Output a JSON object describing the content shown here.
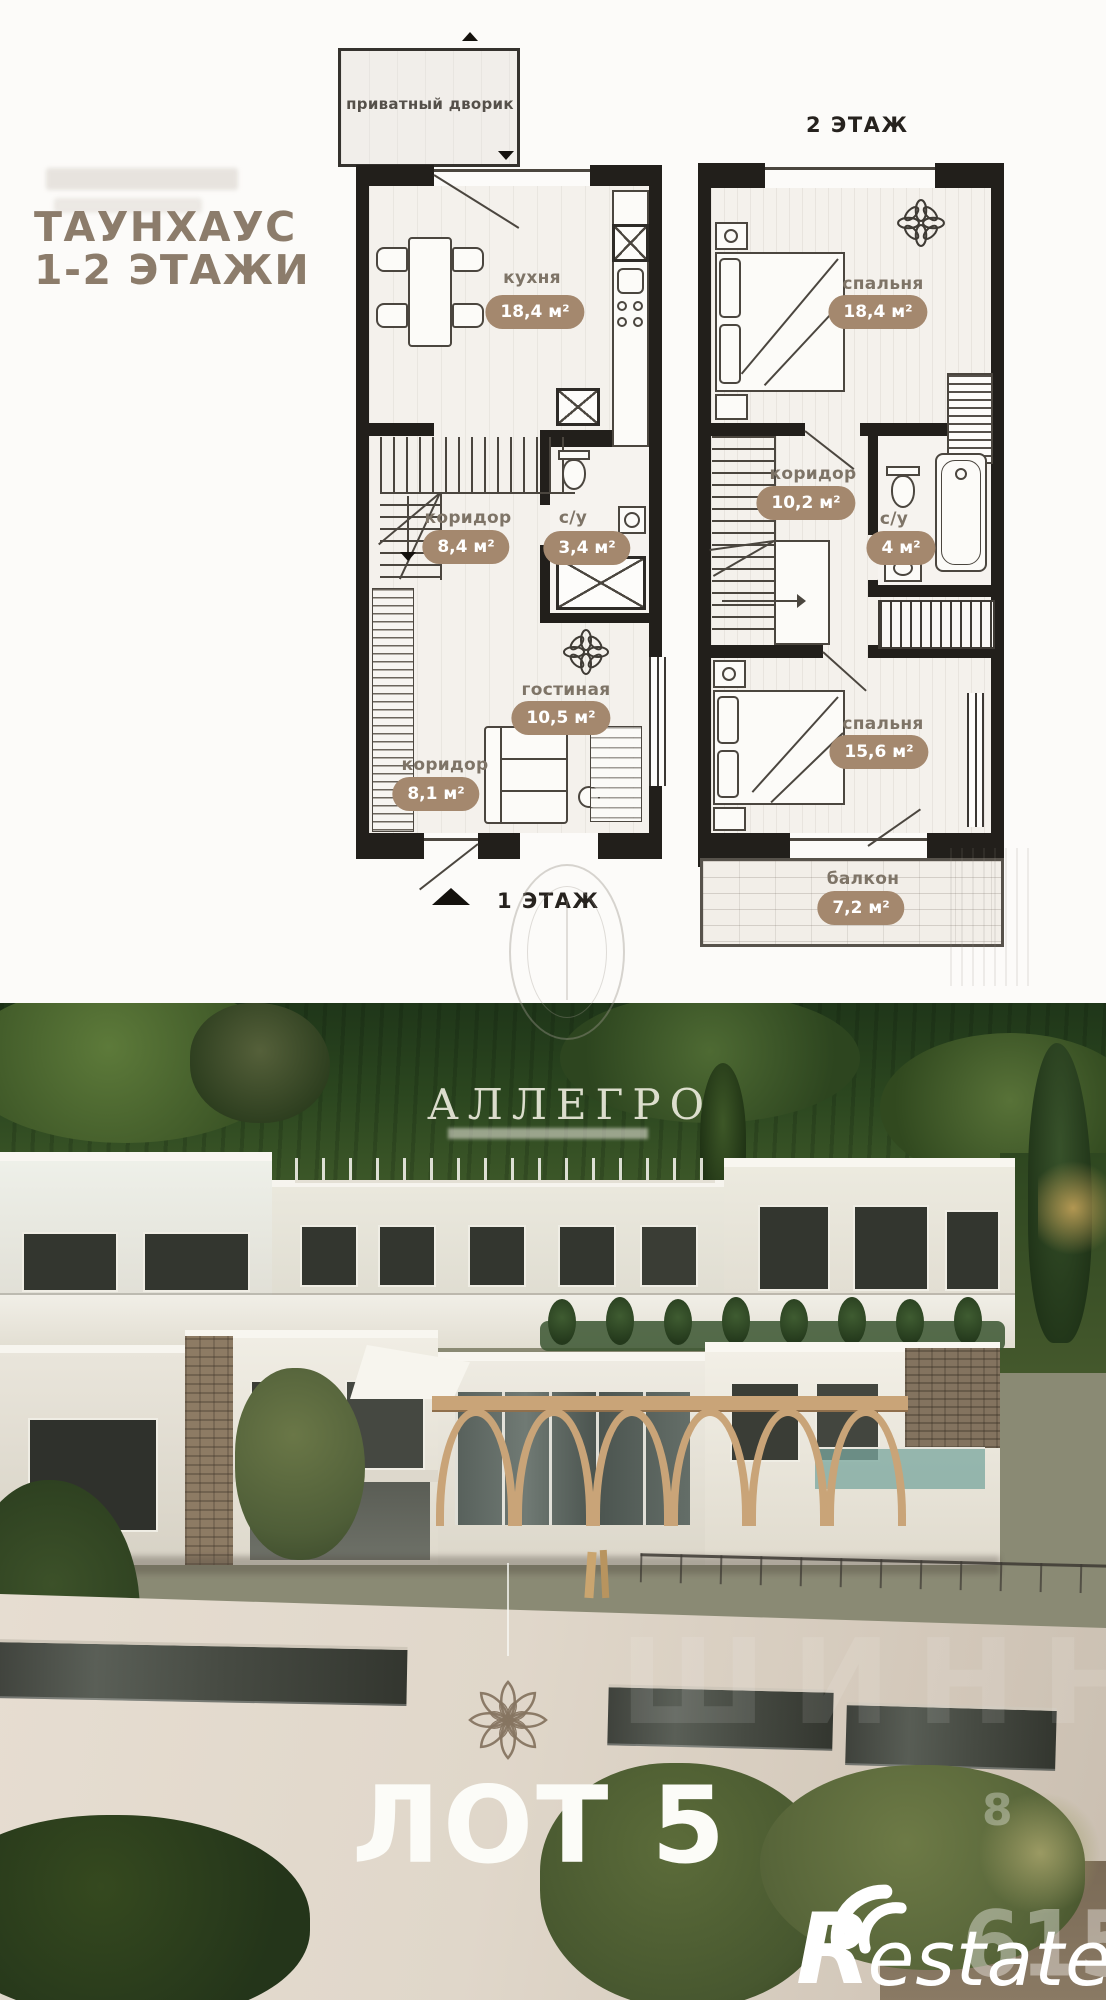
{
  "header": {
    "title_line1": "ТАУНХАУС",
    "title_line2": "1-2 ЭТАЖИ"
  },
  "plan1": {
    "floor_label": "1 ЭТАЖ",
    "courtyard_label": "приватный дворик",
    "rooms": {
      "kitchen": {
        "name": "кухня",
        "area": "18,4 м²"
      },
      "corridor_mid": {
        "name": "коридор",
        "area": "8,4 м²"
      },
      "bathroom": {
        "name": "с/у",
        "area": "3,4 м²"
      },
      "living": {
        "name": "гостиная",
        "area": "10,5 м²"
      },
      "corridor_low": {
        "name": "коридор",
        "area": "8,1 м²"
      }
    }
  },
  "plan2": {
    "floor_label": "2 ЭТАЖ",
    "rooms": {
      "bedroom1": {
        "name": "спальня",
        "area": "18,4 м²"
      },
      "corridor": {
        "name": "коридор",
        "area": "10,2 м²"
      },
      "bathroom": {
        "name": "с/у",
        "area": "4 м²"
      },
      "bedroom2": {
        "name": "спальня",
        "area": "15,6 м²"
      },
      "balcony": {
        "name": "балкон",
        "area": "7,2 м²"
      }
    }
  },
  "photo": {
    "agency_watermark": "АЛЛЕГРО",
    "district_logo": {
      "arc_top": "·МИНДАЛЬ·",
      "arc_left": "РТАЛ",
      "arc_right": "ЖИЛ"
    },
    "lot_label": "ЛОТ 5",
    "ghost_watermark": "ШИНН",
    "ghost_number_small": "8",
    "ghost_number": "615",
    "site_logo": {
      "initial": "R",
      "rest": "estate"
    }
  }
}
